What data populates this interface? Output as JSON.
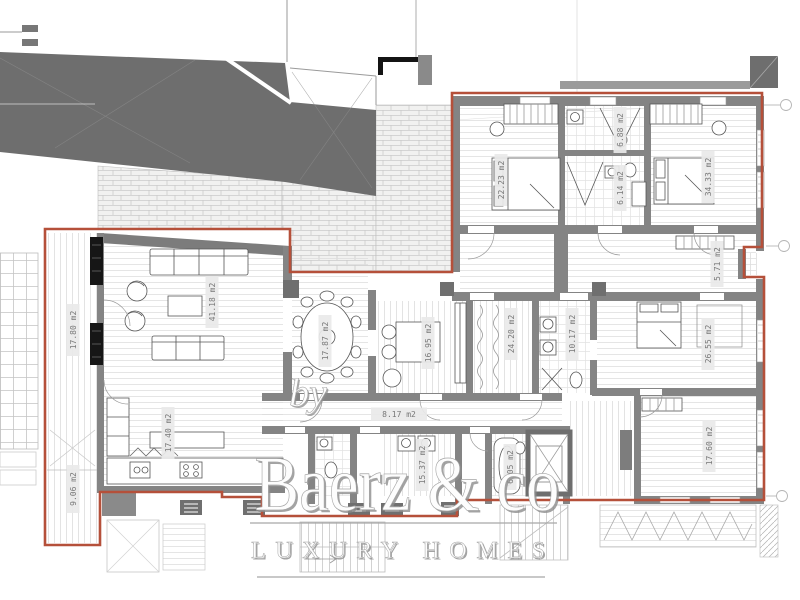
{
  "watermark": {
    "by": "by",
    "brand": "Baerz & co",
    "tagline": "LUXURY HOMES"
  },
  "rooms": {
    "terrace_west": {
      "label": "terrace",
      "area": "17.80 m2"
    },
    "terrace_southwest": {
      "label": "terrace",
      "area": "9.06 m2"
    },
    "living_room": {
      "label": "living room",
      "area": "41.18 m2"
    },
    "dining_room": {
      "label": "dining room",
      "area": "17.87 m2"
    },
    "kitchen": {
      "label": "kitchen",
      "area": "17.40 m2"
    },
    "study": {
      "label": "study",
      "area": "16.95 m2"
    },
    "dressing_room": {
      "label": "dressing",
      "area": "24.20 m2"
    },
    "bathroom_master": {
      "label": "bathroom",
      "area": "10.17 m2"
    },
    "bedroom_master": {
      "label": "bedroom",
      "area": "26.55 m2"
    },
    "bedroom_southeast": {
      "label": "bedroom",
      "area": "17.60 m2"
    },
    "hallway": {
      "label": "hallway",
      "area": "8.17 m2"
    },
    "laundry": {
      "label": "utility",
      "area": "15.37 m2"
    },
    "bathroom_south": {
      "label": "bathroom",
      "area": "6.05 m2"
    },
    "bedroom_northwest": {
      "label": "bedroom",
      "area": "22.23 m2"
    },
    "bathroom_northwest": {
      "label": "bathroom",
      "area": "6.88 m2"
    },
    "shower_room": {
      "label": "shower room",
      "area": "6.14 m2"
    },
    "bedroom_northeast": {
      "label": "bedroom",
      "area": "34.33 m2"
    },
    "balcony_east": {
      "label": "balcony",
      "area": "5.71 m2"
    }
  },
  "colors": {
    "boundary_red": "#b5503a",
    "roof_gray": "#6e6e6e",
    "wall_gray": "#848484",
    "label_bg": "#e9e9e9",
    "label_text": "#787878",
    "watermark_white": "#fdfdfd"
  }
}
